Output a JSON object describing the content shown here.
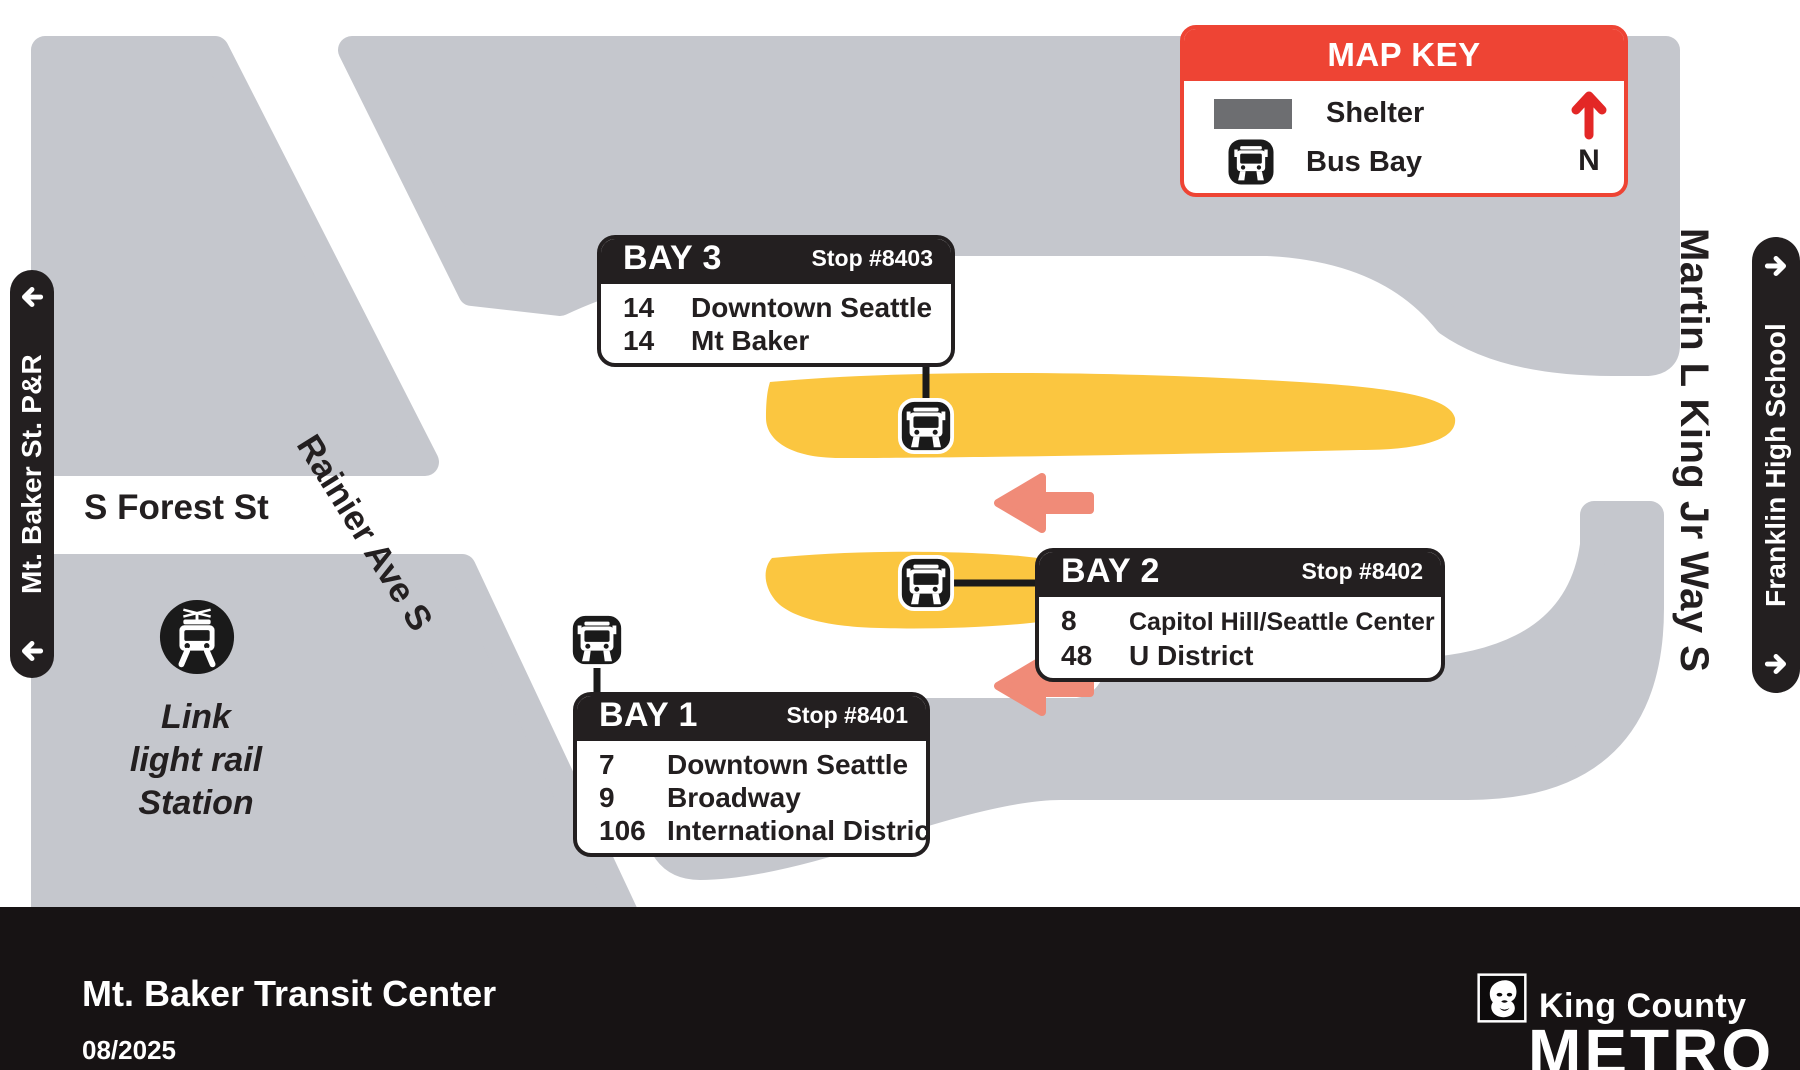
{
  "map_key": {
    "title": "MAP KEY",
    "shelter_label": "Shelter",
    "bus_bay_label": "Bus Bay",
    "north_label": "N"
  },
  "bays": [
    {
      "name": "BAY 3",
      "stop": "Stop #8403",
      "routes": [
        {
          "number": "14",
          "destination": "Downtown Seattle"
        },
        {
          "number": "14",
          "destination": "Mt Baker"
        }
      ]
    },
    {
      "name": "BAY 2",
      "stop": "Stop #8402",
      "routes": [
        {
          "number": "8",
          "destination": "Capitol Hill/Seattle Center"
        },
        {
          "number": "48",
          "destination": "U District"
        }
      ]
    },
    {
      "name": "BAY 1",
      "stop": "Stop #8401",
      "routes": [
        {
          "number": "7",
          "destination": "Downtown Seattle"
        },
        {
          "number": "9",
          "destination": "Broadway"
        },
        {
          "number": "106",
          "destination": "International District"
        }
      ]
    }
  ],
  "streets": {
    "s_forest": "S Forest St",
    "rainier": "Rainier Ave S",
    "mlk": "Martin L King Jr Way S"
  },
  "signs": {
    "left_pill": "Mt. Baker St. P&R",
    "right_pill": "Franklin High School"
  },
  "station": {
    "lines": [
      "Link",
      "light rail",
      "Station"
    ]
  },
  "footer": {
    "title": "Mt. Baker Transit Center",
    "date": "08/2025",
    "agency": "King County",
    "brand": "METRO"
  },
  "colors": {
    "metro_red": "#ee4434",
    "north_red": "#e32726",
    "road_gray": "#c5c7cd",
    "shelter_gray": "#6d6e71",
    "platform_yellow": "#fbc640",
    "arrow_coral": "#f08b78",
    "ink_black": "#231f20"
  }
}
